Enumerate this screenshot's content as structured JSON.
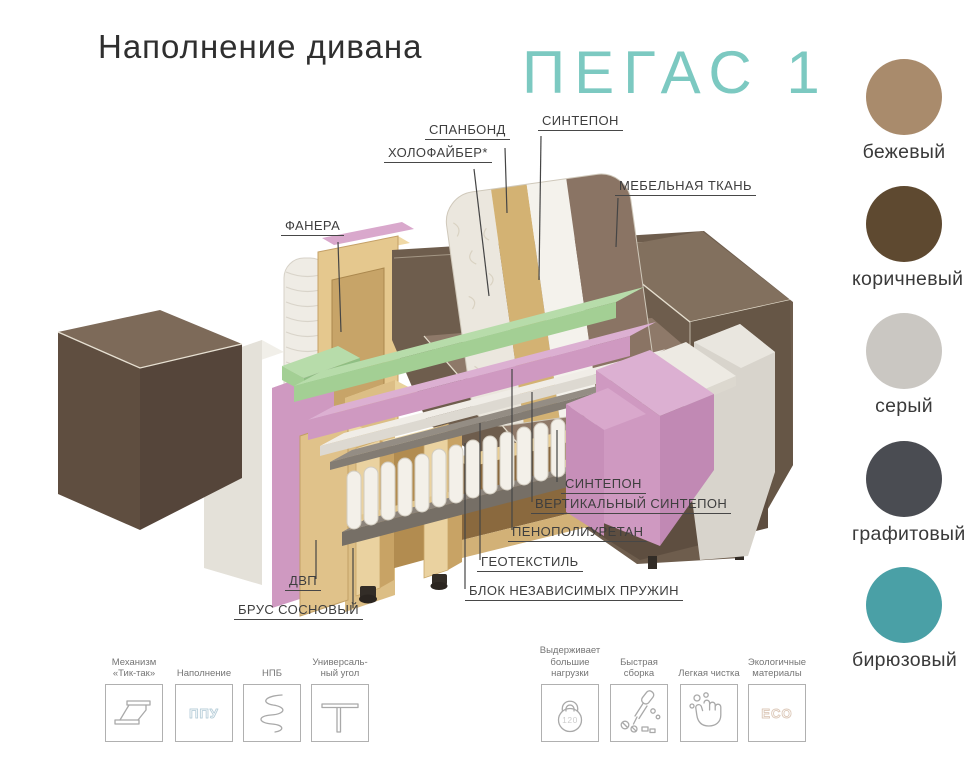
{
  "header": {
    "title": "Наполнение дивана",
    "model": "ПЕГАС 1"
  },
  "diagram": {
    "labels": {
      "spunbond": "СПАНБОНД",
      "sintepon_top": "СИНТЕПОН",
      "holofiber": "ХОЛОФАЙБЕР*",
      "furniture_fabric": "МЕБЕЛЬНАЯ ТКАНЬ",
      "plywood": "ФАНЕРА",
      "sintepon_right": "СИНТЕПОН",
      "vertical_sintepon": "ВЕРТИКАЛЬНЫЙ СИНТЕПОН",
      "polyurethane_foam": "ПЕНОПОЛИУРЕТАН",
      "geotextile": "ГЕОТЕКСТИЛЬ",
      "independent_spring_block": "БЛОК НЕЗАВИСИМЫХ ПРУЖИН",
      "fiberboard": "ДВП",
      "pine_timber": "БРУС СОСНОВЫЙ"
    }
  },
  "colors": {
    "accent_teal": "#7cc9c1",
    "swatches": [
      {
        "name": "бежевый",
        "hex": "#a98b6c"
      },
      {
        "name": "коричневый",
        "hex": "#5e4930"
      },
      {
        "name": "серый",
        "hex": "#cac7c2"
      },
      {
        "name": "графитовый",
        "hex": "#4a4c52"
      },
      {
        "name": "бирюзовый",
        "hex": "#4aa0a6"
      }
    ]
  },
  "features": [
    {
      "label": "Механизм\n«Тик-так»",
      "icon": "tick-tack-mechanism"
    },
    {
      "label": "Наполнение",
      "icon": "ppu-text",
      "icon_text": "ППУ"
    },
    {
      "label": "НПБ",
      "icon": "spring"
    },
    {
      "label": "Универсаль-\nный угол",
      "icon": "universal-corner"
    },
    {
      "label": "Выдерживает\nбольшие\nнагрузки",
      "icon": "kettlebell",
      "icon_text": "120"
    },
    {
      "label": "Быстрая\nсборка",
      "icon": "quick-assembly"
    },
    {
      "label": "Легкая чистка",
      "icon": "easy-cleaning"
    },
    {
      "label": "Экологичные\nматериалы",
      "icon": "eco-text",
      "icon_text": "ECO"
    }
  ]
}
